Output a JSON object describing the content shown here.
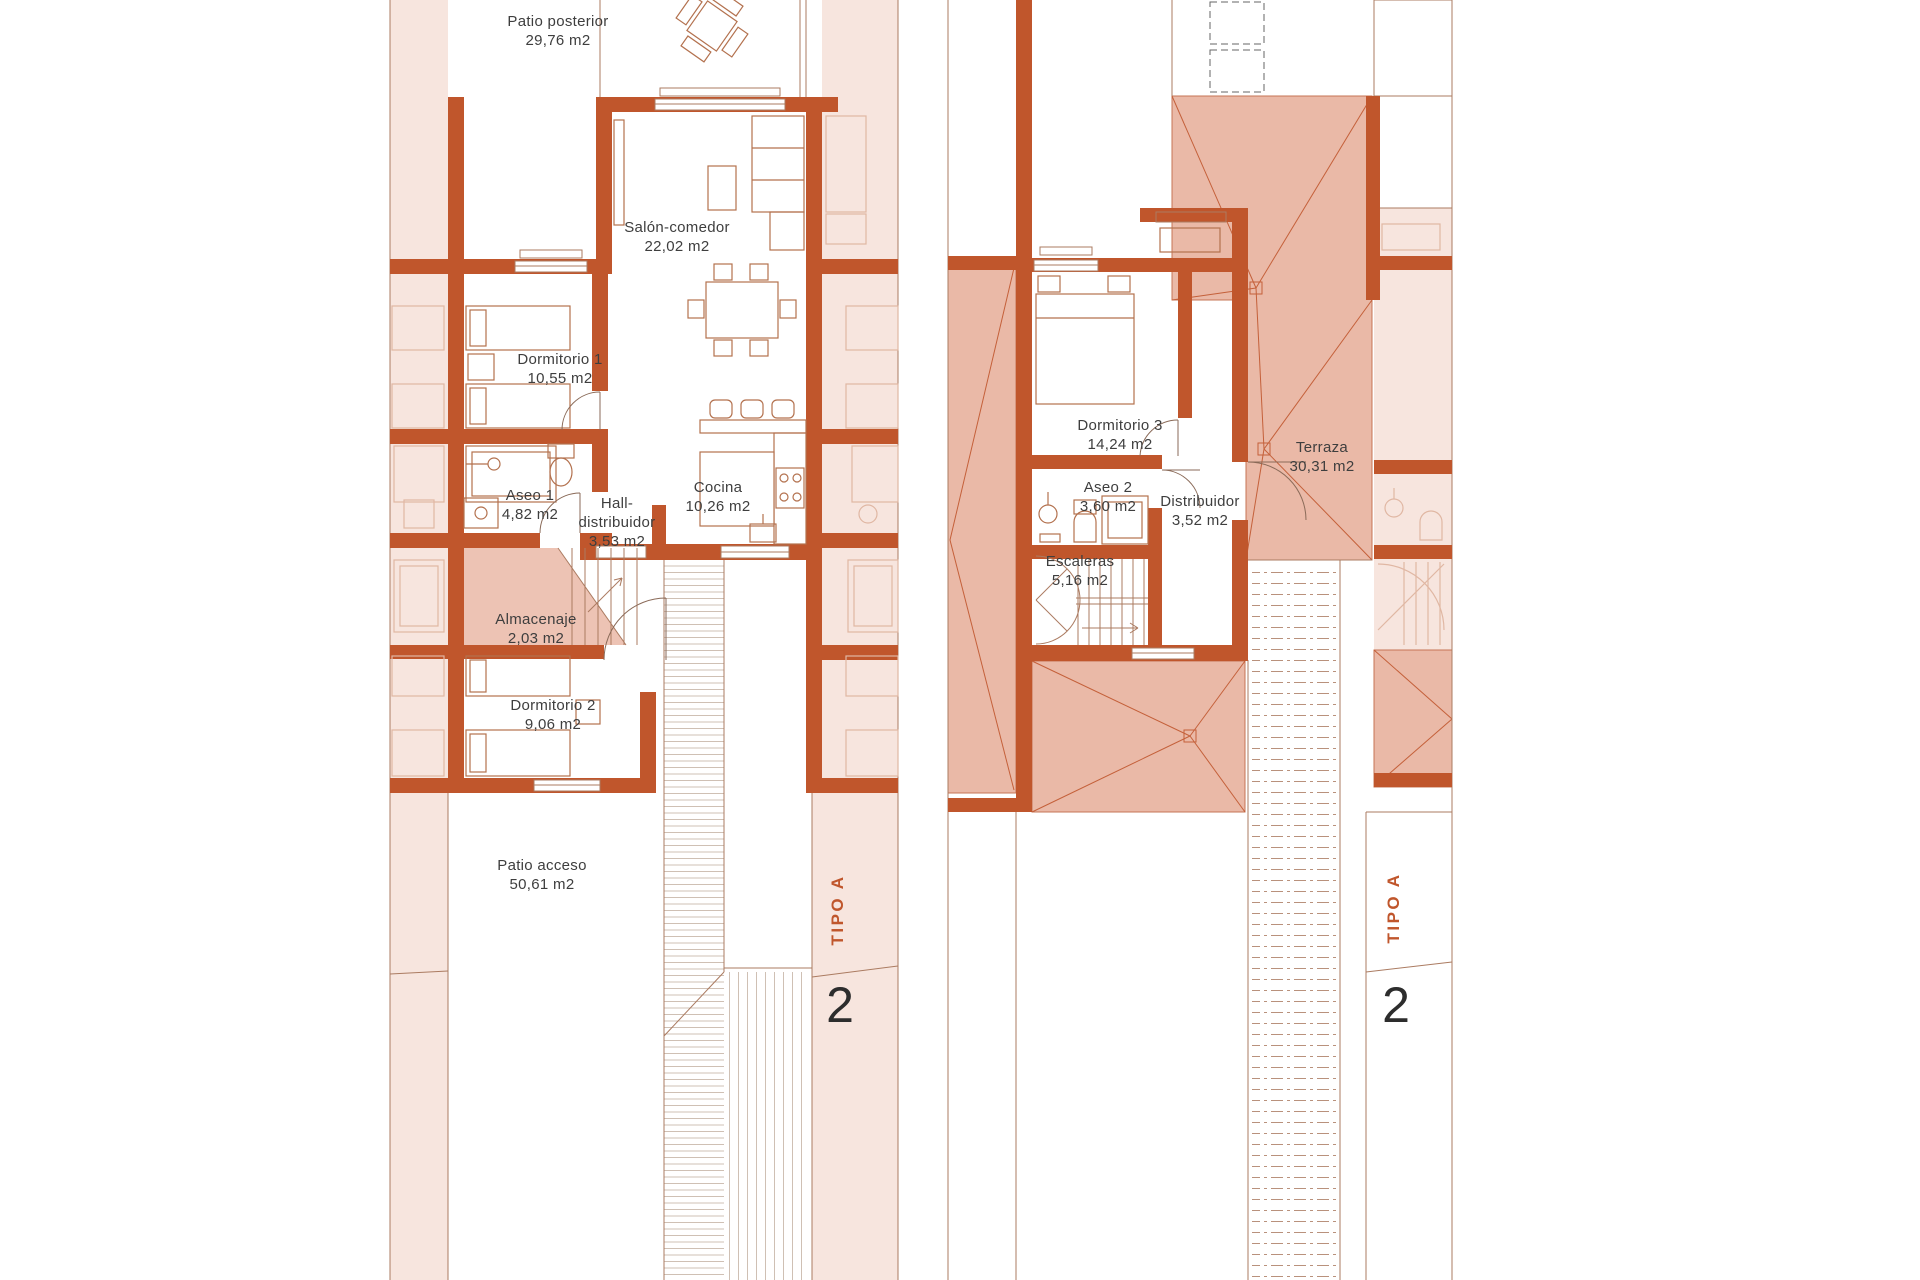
{
  "plans": {
    "left": {
      "rooms": [
        {
          "name": "Patio posterior",
          "area": "29,76 m2"
        },
        {
          "name": "Salón-comedor",
          "area": "22,02 m2"
        },
        {
          "name": "Dormitorio 1",
          "area": "10,55 m2"
        },
        {
          "name": "Aseo 1",
          "area": "4,82 m2"
        },
        {
          "name": "Hall-distribuidor",
          "area": "3,53 m2"
        },
        {
          "name": "Cocina",
          "area": "10,26 m2"
        },
        {
          "name": "Almacenaje",
          "area": "2,03 m2"
        },
        {
          "name": "Dormitorio 2",
          "area": "9,06 m2"
        },
        {
          "name": "Patio acceso",
          "area": "50,61 m2"
        }
      ],
      "type_label": "TIPO A",
      "unit_number": "2"
    },
    "right": {
      "rooms": [
        {
          "name": "Dormitorio 3",
          "area": "14,24 m2"
        },
        {
          "name": "Aseo 2",
          "area": "3,60 m2"
        },
        {
          "name": "Distribuidor",
          "area": "3,52 m2"
        },
        {
          "name": "Escaleras",
          "area": "5,16 m2"
        },
        {
          "name": "Terraza",
          "area": "30,31 m2"
        }
      ],
      "type_label": "TIPO A",
      "unit_number": "2"
    }
  },
  "colors": {
    "wall": "#c0562c",
    "pink": "#f7e5de",
    "roof": "#eab9a7",
    "accent": "#c0562c",
    "text": "#3e3e3e",
    "hatch": "#cfc0b4",
    "line": "#ab7b61",
    "furn": "#b3714e",
    "fade": "#e0b7a3",
    "door": "#8a6a58",
    "dash": "#b9917c"
  }
}
